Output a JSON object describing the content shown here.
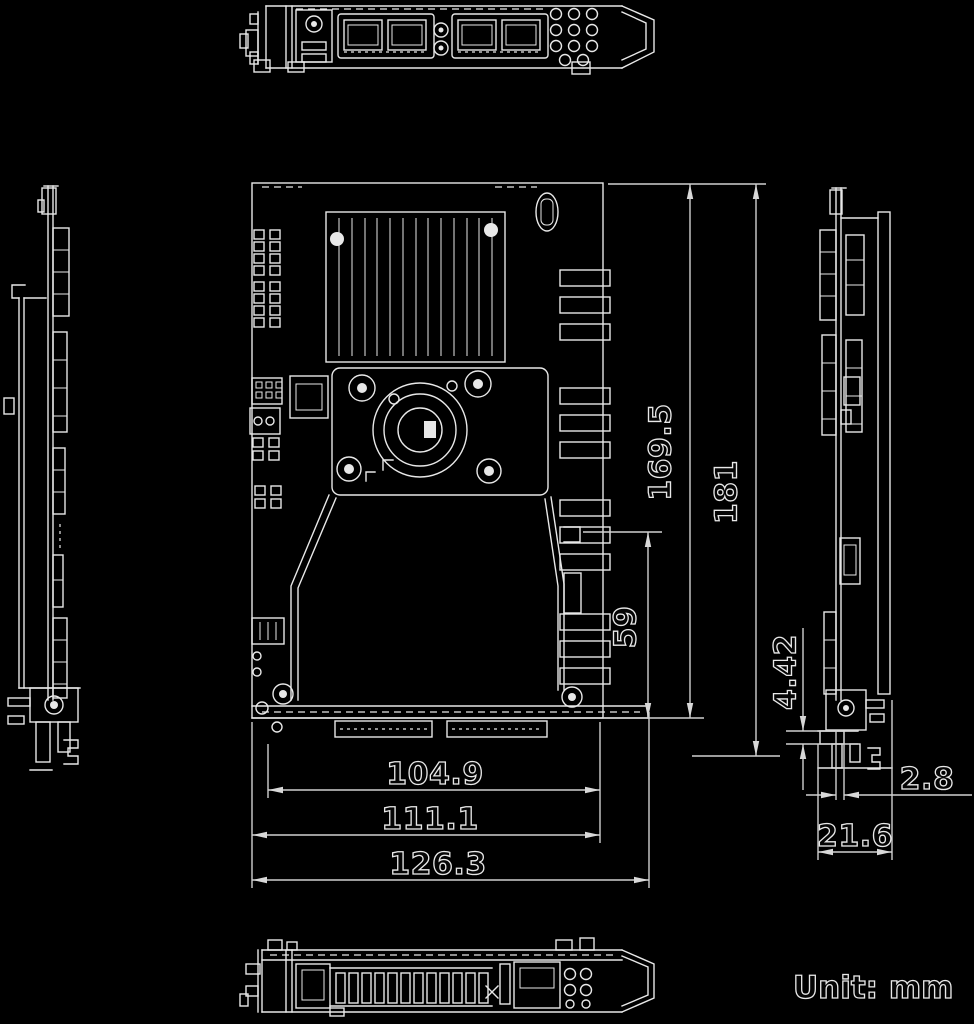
{
  "document": {
    "kind": "mechanical dimension drawing",
    "unit_note": "Unit: mm"
  },
  "colors": {
    "background": "#000000",
    "line": "#e8e8e8",
    "dimension_line": "#cfcfcf"
  },
  "dims": {
    "pcb_length": "169.5",
    "overall_length": "181",
    "shroud_section": "59",
    "connector_width": "104.9",
    "pcb_width": "111.1",
    "overall_width": "126.3",
    "bracket_tab": "4.42",
    "bracket_offset": "2.8",
    "bracket_depth": "21.6"
  }
}
